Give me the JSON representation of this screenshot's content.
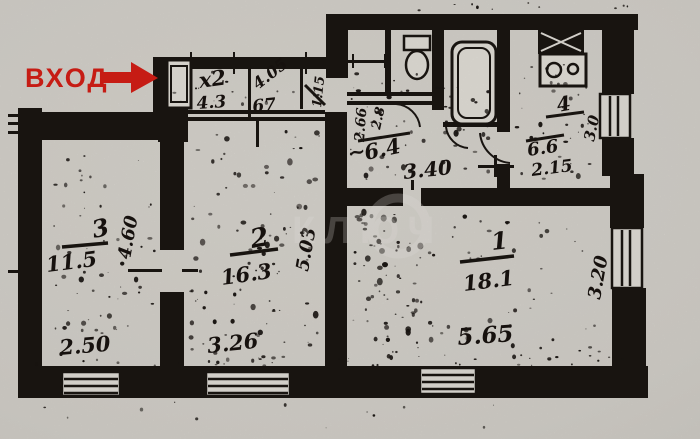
{
  "entrance": {
    "label": "ВХОД"
  },
  "watermark": {
    "text": "КЛЮЧ"
  },
  "rooms": {
    "room1": {
      "number": "1",
      "area": "18.1",
      "width_dim": "5.65",
      "depth_dim": "3.20"
    },
    "room2": {
      "number": "2",
      "area": "16.3",
      "width_dim": "3.26",
      "depth_dim": "5.03"
    },
    "room3": {
      "number": "3",
      "area": "11.5",
      "width_dim": "2.50",
      "depth_dim": "4.60"
    },
    "kitchen": {
      "number": "4",
      "area": "6.6",
      "width_dim": "2.15",
      "depth_dim": "3.0"
    },
    "hallway": {
      "approx_mark": "~",
      "area": "6.4",
      "width_dim": "3.40"
    }
  },
  "corridor_marks": {
    "m1": "х2",
    "m2": "4.3",
    "m3": "4.05",
    "m4": "67",
    "m5": "1.15",
    "m6": "2.66",
    "m7": "2.8"
  },
  "colors": {
    "entrance_red": "#d81f16",
    "ink": "#1b1612",
    "paper": "#d7d4cd"
  }
}
